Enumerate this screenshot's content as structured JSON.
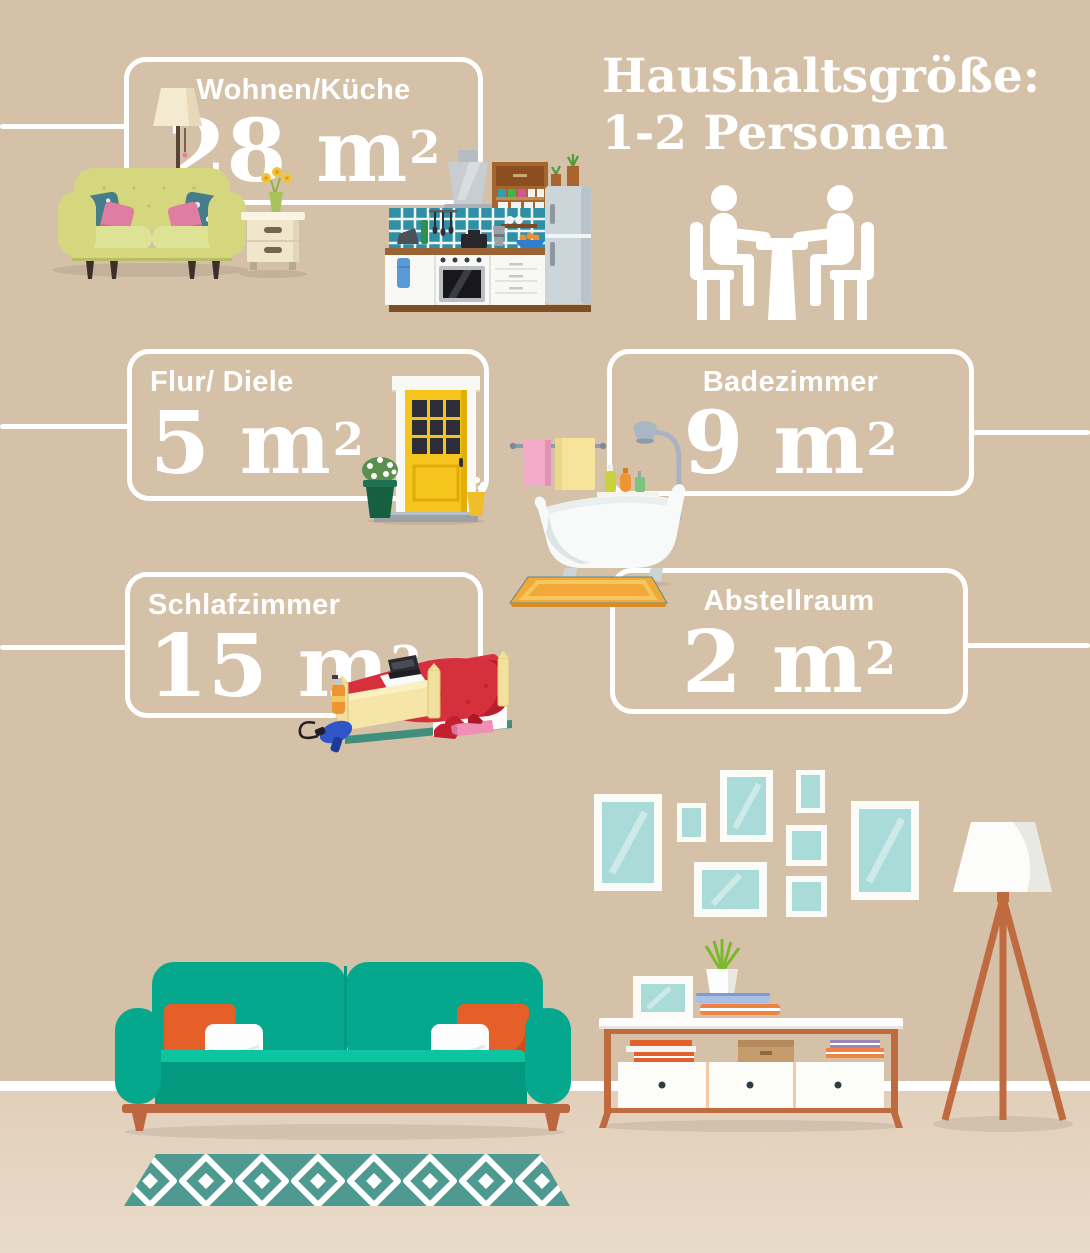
{
  "header": {
    "title_line1": "Haushaltsgröße:",
    "title_line2": "1-2 Personen",
    "household_icon": "two-persons-at-table-icon"
  },
  "rooms": [
    {
      "id": "wohnen-kueche",
      "label": "Wohnen/Küche",
      "area_value": "28 m",
      "area_exponent": "2",
      "illustration": "living-room-and-kitchen"
    },
    {
      "id": "flur-diele",
      "label": "Flur/ Diele",
      "area_value": "5 m",
      "area_exponent": "2",
      "illustration": "front-door-with-plants"
    },
    {
      "id": "badezimmer",
      "label": "Badezimmer",
      "area_value": "9 m",
      "area_exponent": "2",
      "illustration": "bathtub-shower-towels"
    },
    {
      "id": "schlafzimmer",
      "label": "Schlafzimmer",
      "area_value": "15 m",
      "area_exponent": "2",
      "illustration": "bed-with-accessories"
    },
    {
      "id": "abstellraum",
      "label": "Abstellraum",
      "area_value": "2 m",
      "area_exponent": "2",
      "illustration": "storage-room"
    }
  ],
  "scene_icons": [
    "floor-lamp-icon",
    "yellow-sofa-icon",
    "side-table-icon",
    "kitchen-icon",
    "front-door-icon",
    "bathtub-icon",
    "shower-icon",
    "towel-rail-icon",
    "bath-mat-icon",
    "bed-icon",
    "hair-dryer-icon",
    "high-heels-icon",
    "teal-sofa-icon",
    "patterned-rug-icon",
    "picture-frames-gallery-icon",
    "tripod-floor-lamp-icon",
    "sideboard-icon",
    "potted-plant-icon",
    "books-icon"
  ],
  "colors": {
    "wall": "#d5c0a8",
    "floor": "#e7d7c4",
    "baseboard": "#ffffff",
    "card_border": "#ffffff",
    "text": "#ffffff",
    "sofa_teal": "#05a88d",
    "seat_highlight": "#0cc4a2",
    "accent_orange": "#e55f28",
    "wood_copper": "#bd6740",
    "frame_glass_teal": "#a9dbd8",
    "door_yellow": "#f6c51d",
    "rug_teal": "#4f9a90",
    "bed_red": "#d6303c",
    "tile_teal": "#2e8fa7"
  }
}
